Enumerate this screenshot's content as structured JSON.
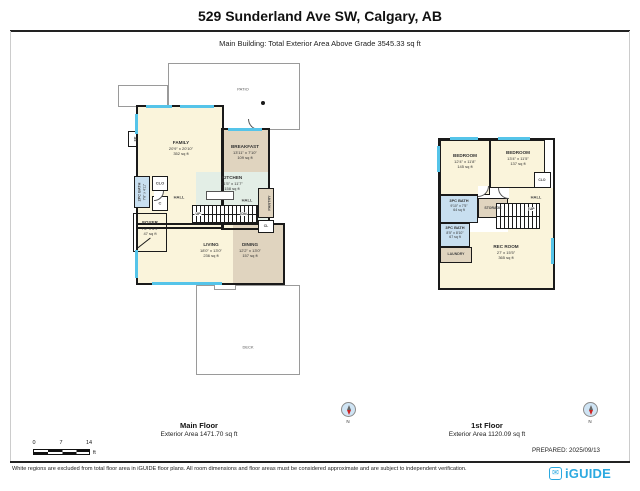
{
  "header": {
    "title": "529 Sunderland Ave SW, Calgary, AB",
    "subtitle": "Main Building: Total Exterior Area Above Grade 3545.33 sq ft"
  },
  "footer": {
    "prepared": "PREPARED: 2025/09/13",
    "disclaimer": "White regions are excluded from total floor area in iGUIDE floor plans. All room dimensions and floor areas must be considered approximate and are subject to independent verification.",
    "brand": "iGUIDE"
  },
  "scale_bar": {
    "tick0": "0",
    "tick1": "7",
    "tick2": "14",
    "unit": "ft"
  },
  "colors": {
    "wall": "#1a1a1a",
    "window_line": "#55C4E9",
    "room_cream": "#FAF4DB",
    "room_tan": "#E0D4BF",
    "room_green": "#E3EEE6",
    "room_blue": "#C8DFF0",
    "outline_gray": "#9a9a9a",
    "brand_blue": "#2BA9E0",
    "compass_red": "#cc2222"
  },
  "floors": [
    {
      "caption": "Main Floor",
      "area": "Exterior Area 1471.70 sq ft",
      "compass_n": "N",
      "rooms": {
        "patio": "PATIO",
        "deck": "DECK",
        "fp": "FP",
        "family": {
          "name": "FAMILY",
          "dims": "20'9\" x 20'10\"",
          "area": "352 sq ft"
        },
        "breakfast": {
          "name": "BREAKFAST",
          "dims": "13'11\" x 7'10\"",
          "area": "109 sq ft"
        },
        "kitchen": {
          "name": "KITCHEN",
          "dims": "21'5\" x 11'7\"",
          "area": "158 sq ft"
        },
        "bath": {
          "name": "2PC BATH",
          "dims": "7'8\" x 4'11\""
        },
        "clo": "CLO",
        "c": "C",
        "hall1": "HALL",
        "hall2": "HALL",
        "pantry": "PANTRY",
        "cl": "CL",
        "foyer": {
          "name": "FOYER",
          "dims": "7'6\" x 6'9\"",
          "area": "47 sq ft"
        },
        "living": {
          "name": "LIVING",
          "dims": "18'0\" x 13'0\"",
          "area": "236 sq ft"
        },
        "dining": {
          "name": "DINING",
          "dims": "12'2\" x 13'0\"",
          "area": "157 sq ft"
        },
        "up": "UP",
        "dn": "DN"
      }
    },
    {
      "caption": "1st Floor",
      "area": "Exterior Area 1120.09 sq ft",
      "compass_n": "N",
      "rooms": {
        "bedroom1": {
          "name": "BEDROOM",
          "dims": "12'4\" x 11'8\"",
          "area": "145 sq ft"
        },
        "bedroom2": {
          "name": "BEDROOM",
          "dims": "13'4\" x 11'5\"",
          "area": "137 sq ft"
        },
        "clo": "CLO",
        "bath1": {
          "name": "3PC BATH",
          "dims": "9'10\" x 7'5\"",
          "area": "64 sq ft"
        },
        "storage": "STORAGE",
        "hall": "HALL",
        "bath2": {
          "name": "3PC BATH",
          "dims": "8'5\" x 8'10\"",
          "area": "67 sq ft"
        },
        "laundry": "LAUNDRY",
        "rec": {
          "name": "REC ROOM",
          "dims": "27' x 15'5\"",
          "area": "365 sq ft"
        },
        "up": "UP"
      }
    }
  ]
}
